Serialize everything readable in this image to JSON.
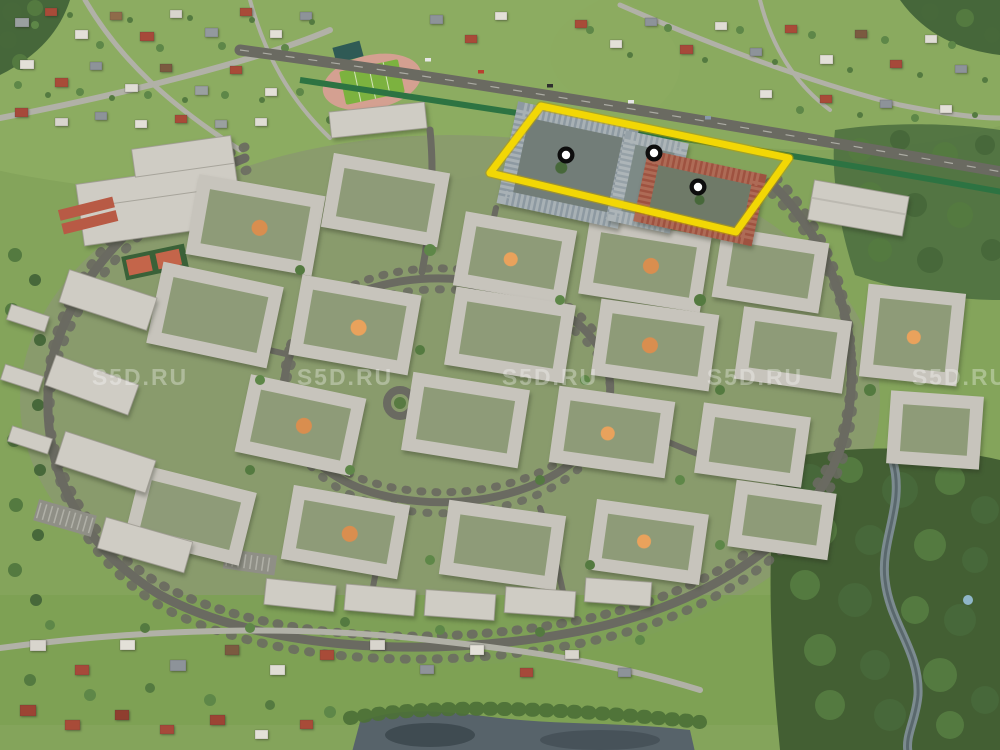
{
  "watermark": {
    "text": "S5D.RU",
    "color": "rgba(255,255,255,0.32)"
  },
  "selection": {
    "outline_points": "541,106 789,158 736,232 490,173",
    "outline_color": "#F2D705",
    "outline_edge_color": "#B99F00",
    "markers": [
      {
        "transform": "translate(566,155)"
      },
      {
        "transform": "translate(654,153)"
      },
      {
        "transform": "translate(698,187)"
      }
    ],
    "marker_ring_color": "#0D0D0D",
    "marker_center_color": "#FFFFFF",
    "highlighted_building_colors": {
      "left": "#8D99A1",
      "middle": "#96A1A7",
      "right": "#9E5240"
    }
  }
}
